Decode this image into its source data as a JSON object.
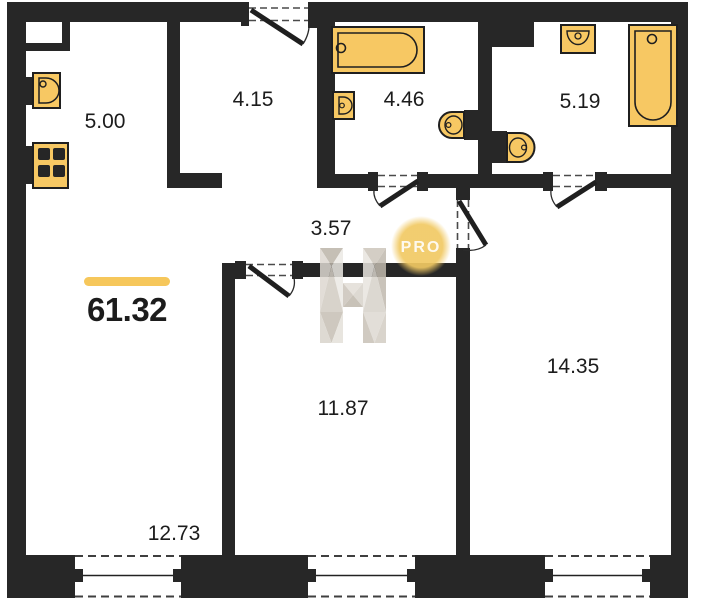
{
  "total_area": {
    "value": "61.32",
    "accent_bar_color": "#F6C75B"
  },
  "rooms": [
    {
      "id": "kitchen-zone",
      "area": "5.00"
    },
    {
      "id": "hallway",
      "area": "4.15"
    },
    {
      "id": "bathroom-1",
      "area": "4.46"
    },
    {
      "id": "bathroom-2",
      "area": "5.19"
    },
    {
      "id": "corridor",
      "area": "3.57"
    },
    {
      "id": "room-middle",
      "area": "11.87"
    },
    {
      "id": "room-right",
      "area": "14.35"
    },
    {
      "id": "living-zone",
      "area": "12.73"
    }
  ],
  "watermark": {
    "badge": "PRO"
  },
  "colors": {
    "walls": "#272727",
    "fixtures": "#F7C863",
    "accent": "#F6C75B",
    "badge": "#F1C963",
    "watermark_tone": "#D6D0C8"
  },
  "icons": [
    "kitchen-sink-icon",
    "stove-icon",
    "bathtub-icon",
    "washbasin-icon",
    "toilet-icon",
    "door-swing-icon",
    "window-icon",
    "h-logo-watermark-icon"
  ]
}
